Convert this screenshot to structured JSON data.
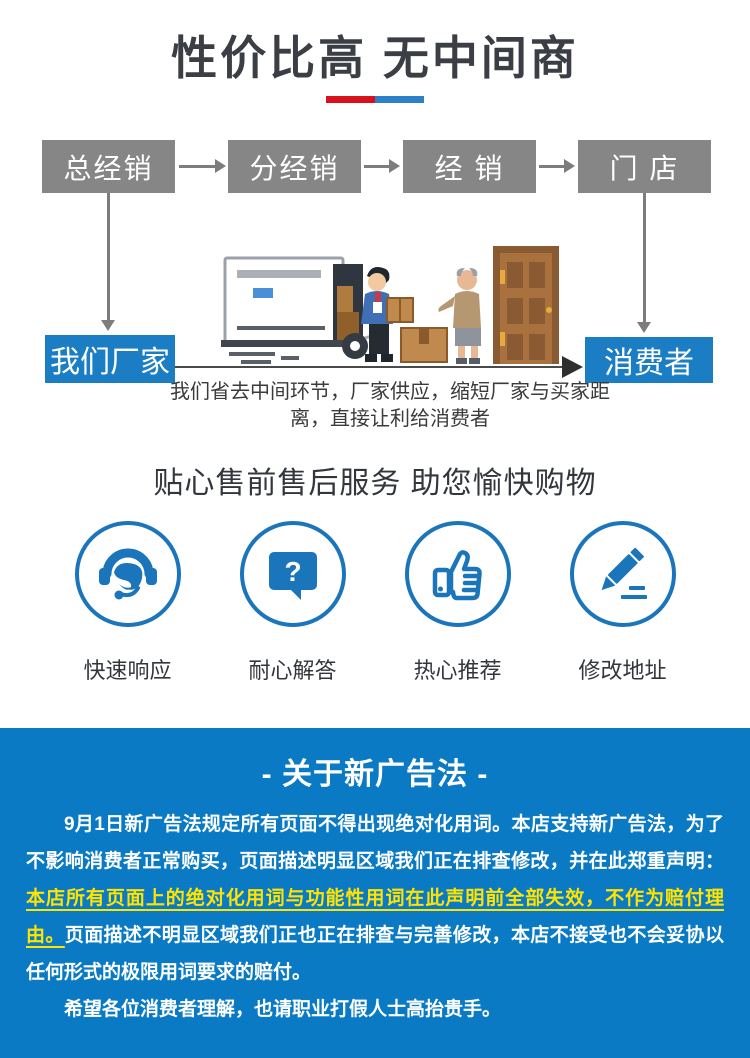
{
  "header": {
    "title": "性价比高 无中间商",
    "divider_red": "#d7111e",
    "divider_blue": "#2b80c6"
  },
  "flow": {
    "boxes": [
      {
        "label": "总经销"
      },
      {
        "label": "分经销"
      },
      {
        "label": "经 销"
      },
      {
        "label": "门 店"
      }
    ],
    "factory_label": "我们厂家",
    "consumer_label": "消费者",
    "caption_line1": "我们省去中间环节，厂家供应，缩短厂家与买家距",
    "caption_line2": "离，直接让利给消费者",
    "box_color": "#868686",
    "accent_blue": "#1b7ec4"
  },
  "services": {
    "title": "贴心售前售后服务 助您愉快购物",
    "icon_color": "#1b75bb",
    "items": [
      {
        "icon": "headset-icon",
        "label": "快速响应"
      },
      {
        "icon": "question-bubble-icon",
        "label": "耐心解答"
      },
      {
        "icon": "thumbs-up-icon",
        "label": "热心推荐"
      },
      {
        "icon": "pencil-icon",
        "label": "修改地址"
      }
    ]
  },
  "notice": {
    "title": "- 关于新广告法 -",
    "background": "#0a7ac5",
    "highlight_color": "#ffe400",
    "paragraph1_segments": [
      {
        "style": "normal",
        "text": "9月1日新广告法规定所有页面不得出现绝对化用词。本店支持新广告法，为了不影响消费者正常购买，页面描述明显区域我们正在排查修改，并在此郑重声明："
      },
      {
        "style": "highlight",
        "text": "本店所有页面上的绝对化用词与功能性用词在此声明前全部失效，不作为赔付理由。"
      },
      {
        "style": "normal",
        "text": "页面描述不明显区域我们正也正在排查与完善修改，本店不接受也不会妥协以任何形式的极限用词要求的赔付。"
      }
    ],
    "paragraph2": "希望各位消费者理解，也请职业打假人士高抬贵手。"
  }
}
